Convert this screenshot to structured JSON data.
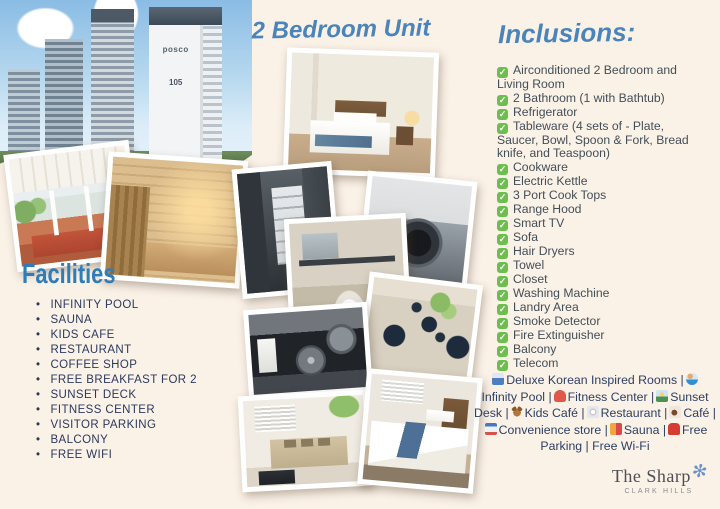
{
  "colors": {
    "background": "#faf1e7",
    "accent_blue": "#4b84ba",
    "heading_blue": "#2e7cb8",
    "check_green": "#6cbf4f",
    "facilities_text": "#2b3a5c",
    "inclusions_text": "#434f58",
    "footer_text": "#2d3f63"
  },
  "left": {
    "building_photo": {
      "brand": "posco",
      "tower_number": "105"
    },
    "facilities": {
      "title": "Facilities",
      "items": [
        "INFINITY POOL",
        "SAUNA",
        "KIDS CAFE",
        "RESTAURANT",
        "COFFEE SHOP",
        "FREE BREAKFAST FOR 2",
        "SUNSET DECK",
        "FITNESS CENTER",
        "VISITOR PARKING",
        "BALCONY",
        "FREE WIFI"
      ]
    }
  },
  "center": {
    "title": "2 Bedroom Unit"
  },
  "right": {
    "inclusions": {
      "title": "Inclusions:",
      "check_glyph": "✓",
      "items": [
        "Airconditioned 2 Bedroom and Living Room",
        "2 Bathroom (1 with Bathtub)",
        "Refrigerator",
        "Tableware (4 sets of - Plate, Saucer, Bowl, Spoon & Fork, Bread knife, and Teaspoon)",
        "Cookware",
        "Electric Kettle",
        "3 Port Cook Tops",
        "Range Hood",
        "Smart TV",
        "Sofa",
        "Hair Dryers",
        "Towel",
        "Closet",
        "Washing Machine",
        "Landry Area",
        "Smoke Detector",
        "Fire Extinguisher",
        "Balcony",
        "Telecom"
      ]
    },
    "amenities_footer": {
      "separator": "|",
      "segments": [
        {
          "icon": "bed-icon",
          "label": "Deluxe Korean Inspired Rooms"
        },
        {
          "icon": "swimmer-icon",
          "label": "Infinity Pool"
        },
        {
          "icon": "weightlifter-icon",
          "label": "Fitness Center"
        },
        {
          "icon": "sunrise-mountain-icon",
          "label": "Sunset Desk"
        },
        {
          "icon": "teddy-bear-icon",
          "label": "Kids Café"
        },
        {
          "icon": "fork-plate-icon",
          "label": "Restaurant"
        },
        {
          "icon": "coffee-cup-icon",
          "label": "Café"
        },
        {
          "icon": "convenience-store-icon",
          "label": "Convenience store"
        },
        {
          "icon": "sauna-person-icon",
          "label": "Sauna"
        },
        {
          "icon": "car-icon",
          "label": "Free Parking"
        },
        {
          "icon": null,
          "label": "Free Wi-Fi"
        }
      ]
    },
    "brand": {
      "name": "The Sharp",
      "sub": "CLARK HILLS",
      "star_glyph": "✻"
    }
  }
}
